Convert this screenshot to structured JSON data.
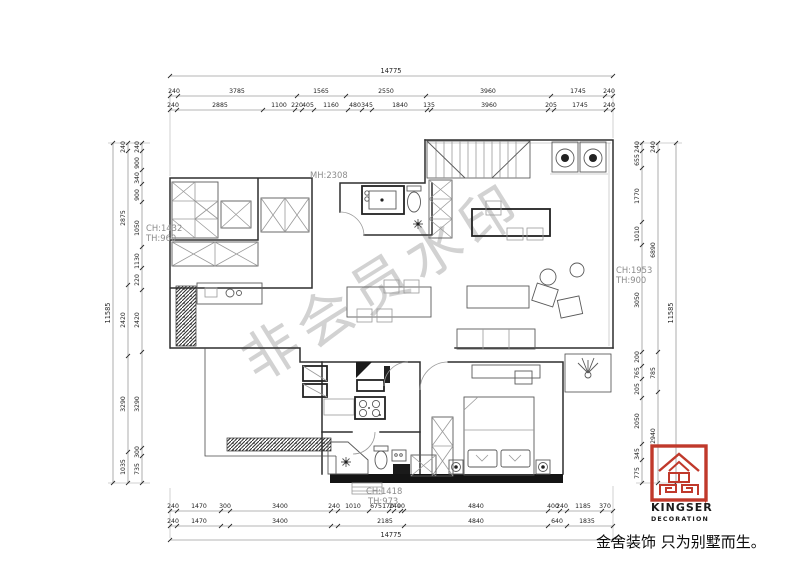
{
  "watermark": "非会员水印",
  "slogan": "金舍装饰 只为别墅而生。",
  "logo": {
    "brand": "KINGSER",
    "mark": "'",
    "sub": "DECORATION"
  },
  "annotations": {
    "bath": {
      "mh": "MH:2308"
    },
    "left": {
      "ch": "CH:1432",
      "th": "TH:960"
    },
    "right": {
      "ch": "CH:1953",
      "th": "TH:900"
    },
    "bottom": {
      "ch": "CH:1418",
      "th": "TH:973"
    }
  },
  "dimensions": {
    "top": {
      "total": "14775",
      "row1": [
        "240",
        "3785",
        "1565",
        "2550",
        "3960",
        "1745",
        "240"
      ],
      "row2": [
        "240",
        "2885",
        "1100",
        "220",
        "405",
        "1160",
        "480",
        "345",
        "1840",
        "135",
        "3960",
        "205",
        "1745",
        "240"
      ]
    },
    "bottom": {
      "total": "14775",
      "row1": [
        "240",
        "1470",
        "300",
        "3400",
        "240",
        "1010",
        "675",
        "170",
        "240",
        "90",
        "4840",
        "400",
        "240",
        "1185",
        "370"
      ],
      "row2": [
        "240",
        "1470",
        "3400",
        "2185",
        "4840",
        "640",
        "1835"
      ]
    },
    "left": {
      "total": "11585",
      "outer": [
        "240",
        "2875",
        "2420",
        "3290",
        "1035"
      ],
      "inner": [
        "240",
        "900",
        "340",
        "900",
        "1050",
        "1130",
        "220",
        "2420",
        "3290",
        "300",
        "735"
      ]
    },
    "right": {
      "total": "11585",
      "outer": [
        "240",
        "6890",
        "785",
        "2940"
      ],
      "inner": [
        "240",
        "655",
        "1770",
        "1010",
        "3050",
        "200",
        "765",
        "205",
        "2050",
        "345",
        "775"
      ]
    }
  },
  "colors": {
    "logo_red": "#c0392b",
    "wall_line": "#2f2f2f",
    "annotation_gray": "#8c8c8c",
    "watermark_gray": "#d2d2d2"
  }
}
